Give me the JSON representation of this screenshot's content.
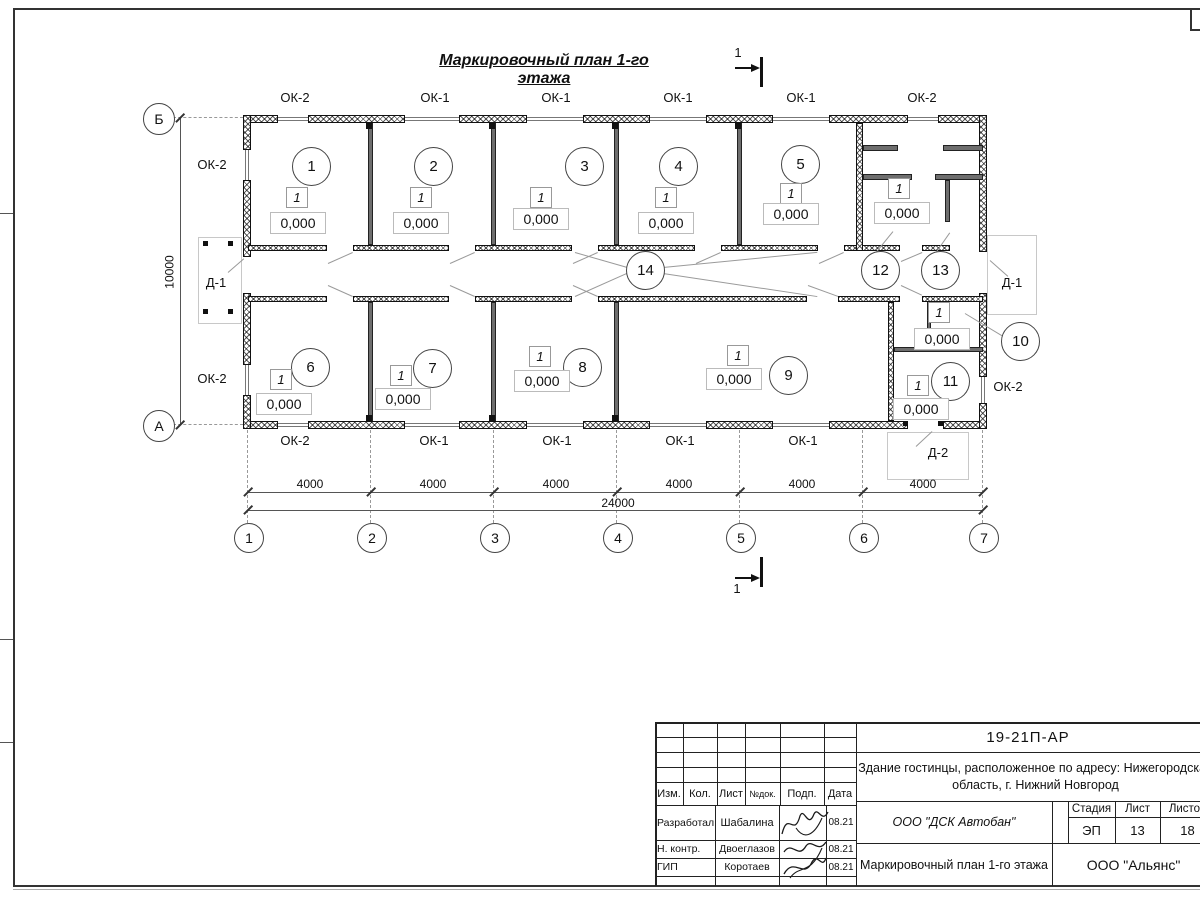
{
  "drawing_title": "Маркировочный план 1-го этажа",
  "plan": {
    "rooms": [
      "1",
      "2",
      "3",
      "4",
      "5",
      "6",
      "7",
      "8",
      "9",
      "10",
      "11",
      "12",
      "13",
      "14"
    ],
    "marks": [
      {
        "room": "1",
        "floor_type": "1",
        "elevation": "0,000"
      },
      {
        "room": "2",
        "floor_type": "1",
        "elevation": "0,000"
      },
      {
        "room": "3",
        "floor_type": "1",
        "elevation": "0,000"
      },
      {
        "room": "4",
        "floor_type": "1",
        "elevation": "0,000"
      },
      {
        "room": "5",
        "floor_type": "1",
        "elevation": "0,000"
      },
      {
        "room": "6",
        "floor_type": "1",
        "elevation": "0,000"
      },
      {
        "room": "7",
        "floor_type": "1",
        "elevation": "0,000"
      },
      {
        "room": "8",
        "floor_type": "1",
        "elevation": "0,000"
      },
      {
        "room": "9",
        "floor_type": "1",
        "elevation": "0,000"
      },
      {
        "room": "10",
        "floor_type": "1",
        "elevation": "0,000"
      },
      {
        "room": "11",
        "floor_type": "1",
        "elevation": "0,000"
      },
      {
        "room": "12-13",
        "floor_type": "1",
        "elevation": "0,000"
      }
    ],
    "window_labels": {
      "top": [
        "ОК-2",
        "ОК-1",
        "ОК-1",
        "ОК-1",
        "ОК-1",
        "ОК-2"
      ],
      "bottom": [
        "ОК-2",
        "ОК-1",
        "ОК-1",
        "ОК-1",
        "ОК-1"
      ],
      "left": [
        "ОК-2",
        "ОК-2"
      ],
      "right": [
        "ОК-2"
      ]
    },
    "door_labels": {
      "left": "Д-1",
      "right": "Д-1",
      "bottom": "Д-2"
    },
    "axes": {
      "bottom": [
        "1",
        "2",
        "3",
        "4",
        "5",
        "6",
        "7"
      ],
      "left": [
        "Б",
        "А"
      ]
    },
    "dims": {
      "bays": [
        "4000",
        "4000",
        "4000",
        "4000",
        "4000",
        "4000"
      ],
      "total": "24000",
      "height": "10000"
    },
    "section_label": "1"
  },
  "title_block": {
    "doc_number": "19-21П-АР",
    "project_line1": "Здание гостинцы, расположенное по адресу: Нижегородская",
    "project_line2": "область, г. Нижний Новгород",
    "contractor": "ООО \"ДСК Автобан\"",
    "sheet_title": "Маркировочный план 1-го этажа",
    "organization": "ООО \"Альянс\"",
    "stage_label": "Стадия",
    "sheet_label": "Лист",
    "sheets_label": "Листов",
    "stage": "ЭП",
    "sheet": "13",
    "sheets": "18",
    "columns": [
      "Изм.",
      "Кол.",
      "Лист",
      "№док.",
      "Подп.",
      "Дата"
    ],
    "signers": [
      {
        "role": "Разработал",
        "name": "Шабалина",
        "date": "08.21"
      },
      {
        "role": "Н. контр.",
        "name": "Двоеглазов",
        "date": "08.21"
      },
      {
        "role": "ГИП",
        "name": "Коротаев",
        "date": "08.21"
      }
    ]
  }
}
